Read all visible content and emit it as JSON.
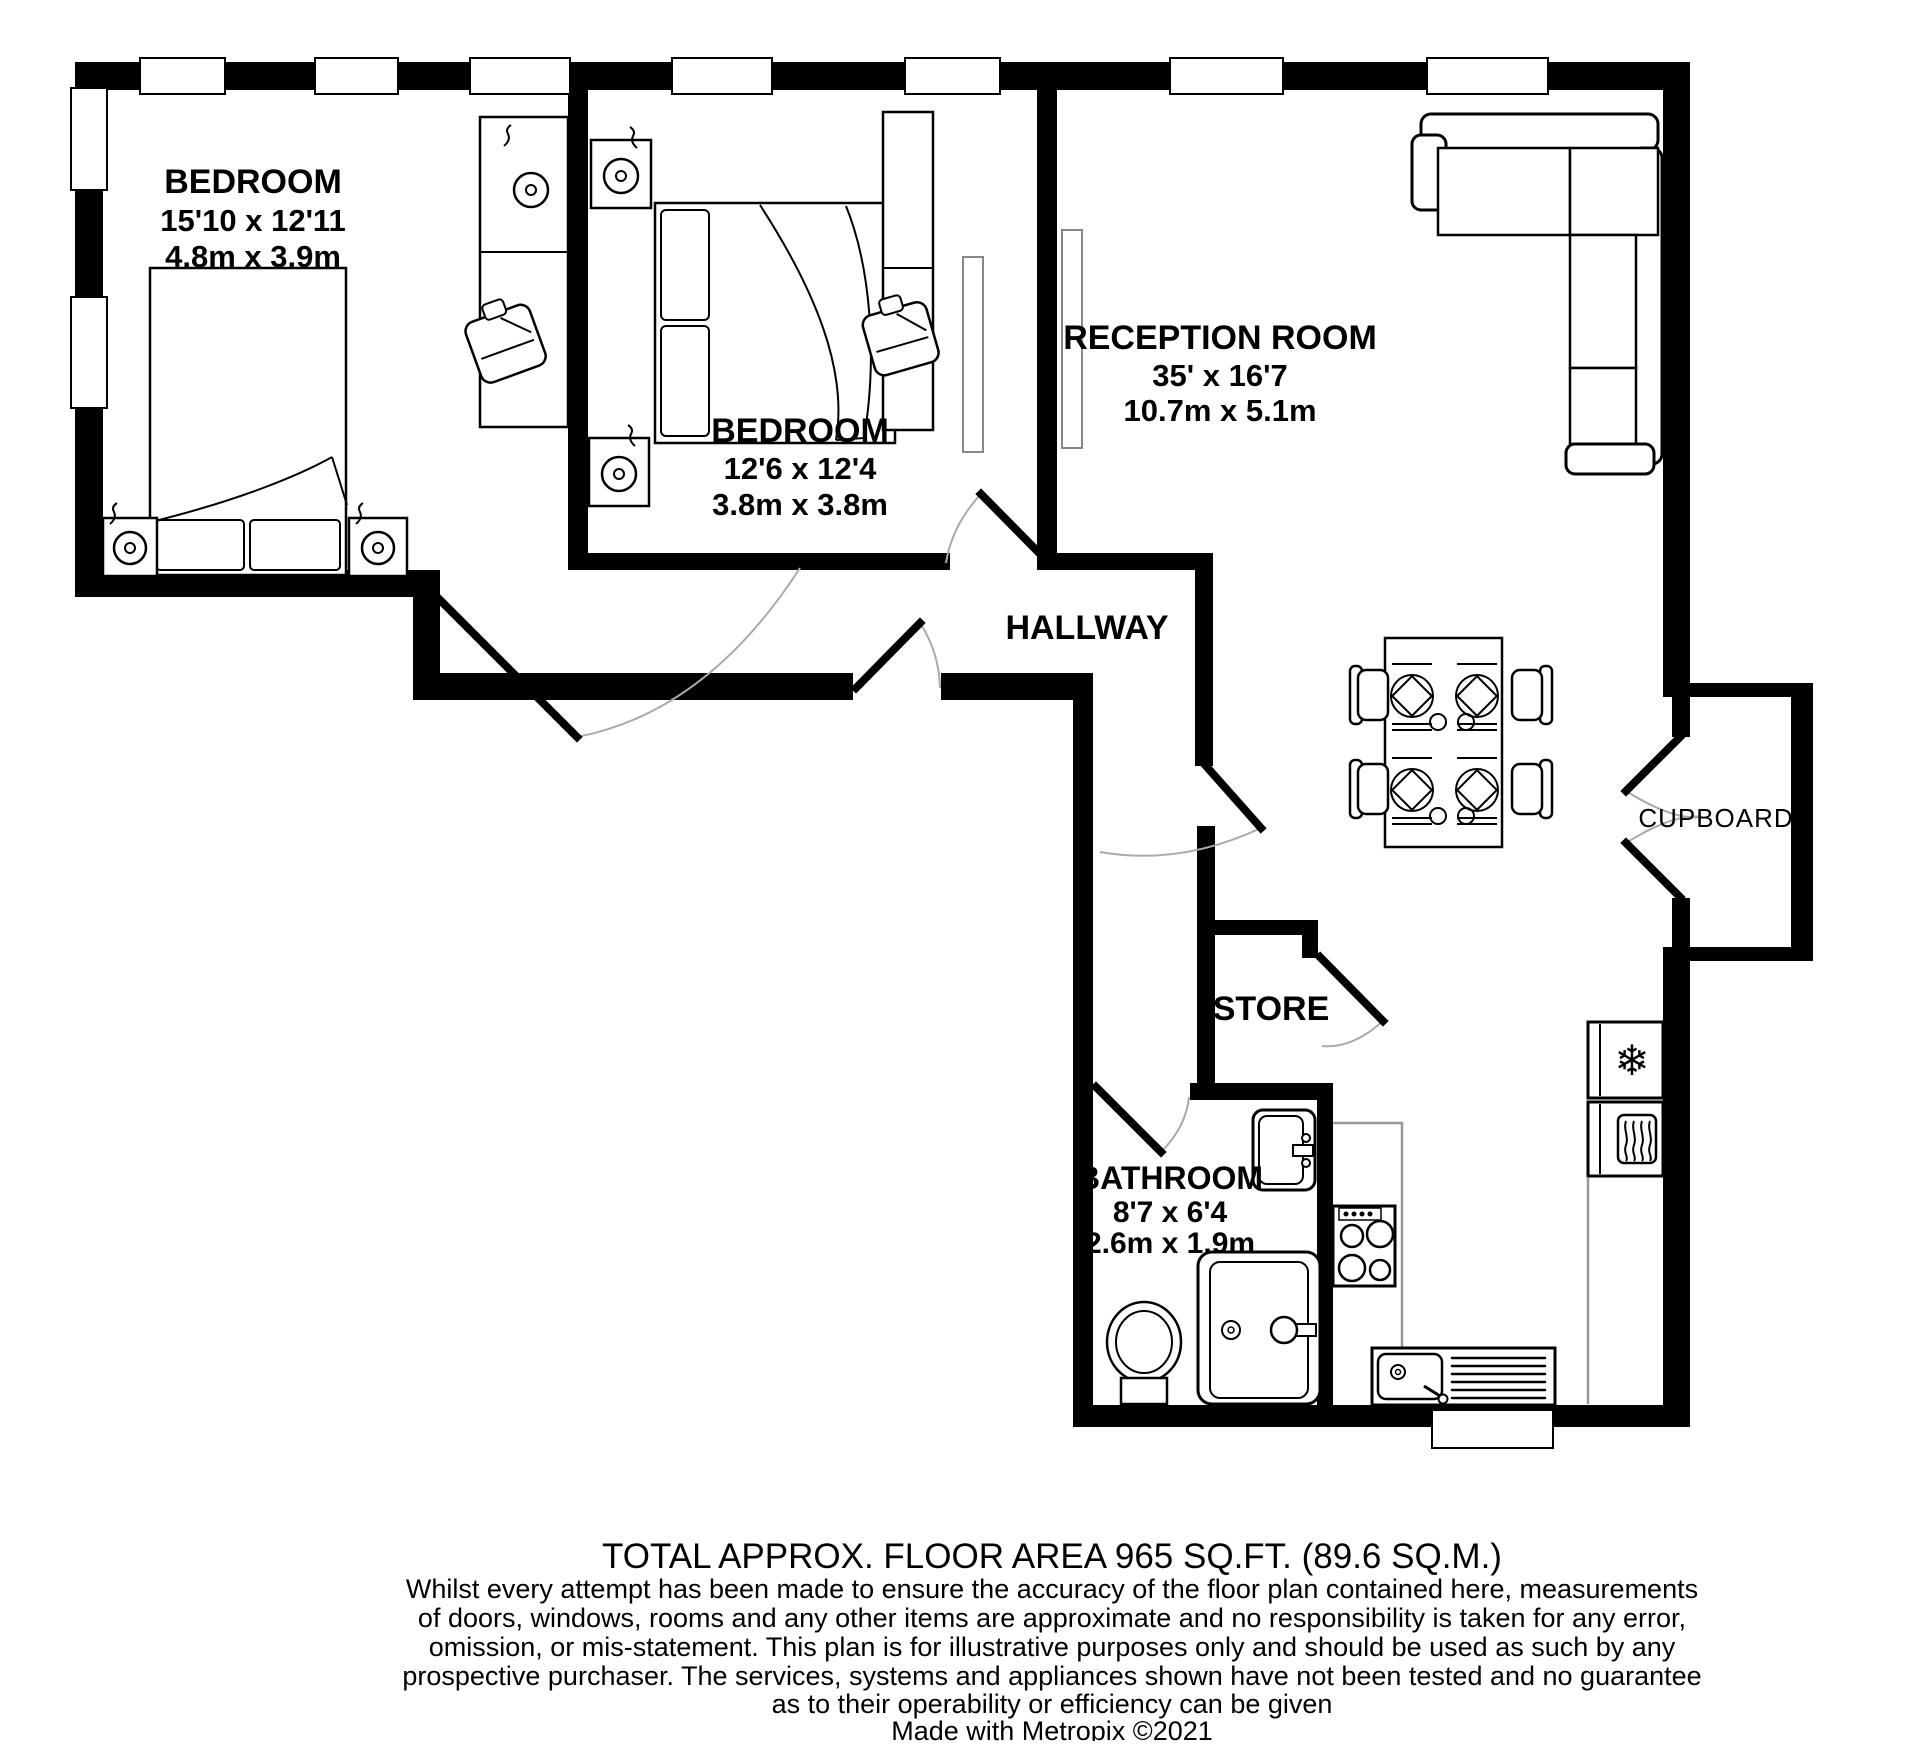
{
  "plan": {
    "rooms": [
      {
        "id": "bedroom-1",
        "name": "BEDROOM",
        "size_imperial": "15'10 x 12'11",
        "size_metric": "4.8m x 3.9m"
      },
      {
        "id": "bedroom-2",
        "name": "BEDROOM",
        "size_imperial": "12'6 x 12'4",
        "size_metric": "3.8m x 3.8m"
      },
      {
        "id": "reception-room",
        "name": "RECEPTION ROOM",
        "size_imperial": "35' x 16'7",
        "size_metric": "10.7m x 5.1m"
      },
      {
        "id": "hallway",
        "name": "HALLWAY"
      },
      {
        "id": "store",
        "name": "STORE"
      },
      {
        "id": "bathroom",
        "name": "BATHROOM",
        "size_imperial": "8'7 x 6'4",
        "size_metric": "2.6m x 1.9m"
      },
      {
        "id": "cupboard",
        "name": "CUPBOARD"
      }
    ],
    "icons": {
      "fridge_snowflake": "❄"
    },
    "colors": {
      "wall": "#000000",
      "furniture_outline": "#000000",
      "counter_gray": "#999999",
      "door_arc_gray": "#aaaaaa"
    }
  },
  "footer": {
    "title": "TOTAL APPROX. FLOOR AREA 965 SQ.FT. (89.6 SQ.M.)",
    "disclaimer_lines": [
      "Whilst every attempt has been made to ensure the accuracy of the floor plan contained here, measurements",
      "of doors, windows, rooms and any other items are approximate and no responsibility is taken for any error,",
      "omission, or mis-statement. This plan is for illustrative purposes only and should be used as such by any",
      "prospective purchaser. The services, systems and appliances shown have not been tested and no guarantee",
      "as to their operability or efficiency can be given"
    ],
    "credit": "Made with Metropix ©2021"
  }
}
